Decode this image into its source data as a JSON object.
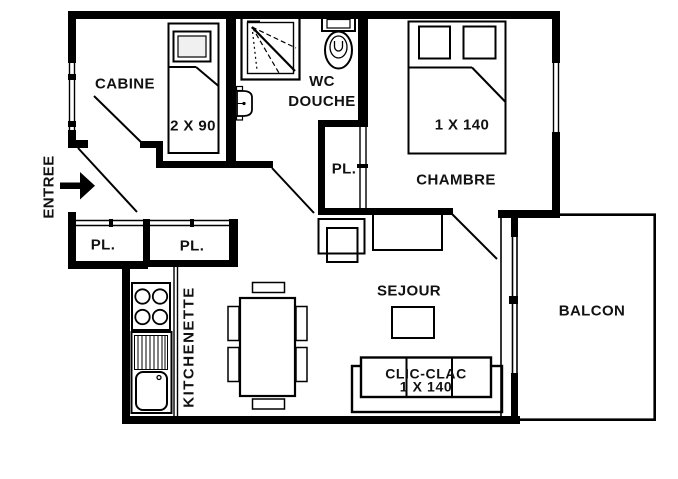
{
  "plan": {
    "rooms": {
      "cabine": {
        "label": "CABINE",
        "bed_label": "2 X 90"
      },
      "wc_douche": {
        "label_line1": "WC",
        "label_line2": "DOUCHE"
      },
      "chambre": {
        "label": "CHAMBRE",
        "bed_label": "1 X 140"
      },
      "sejour": {
        "label": "SEJOUR",
        "sofa_label_line1": "CLIC-CLAC",
        "sofa_label_line2": "1 X 140"
      },
      "kitchenette": {
        "label": "KITCHENETTE"
      },
      "balcon": {
        "label": "BALCON"
      },
      "entree": {
        "label": "ENTREE"
      },
      "closets": {
        "hall": "PL.",
        "entry_left": "PL.",
        "entry_right": "PL."
      }
    },
    "colors": {
      "wall": "#000000",
      "background": "#ffffff",
      "text": "#111111"
    }
  }
}
